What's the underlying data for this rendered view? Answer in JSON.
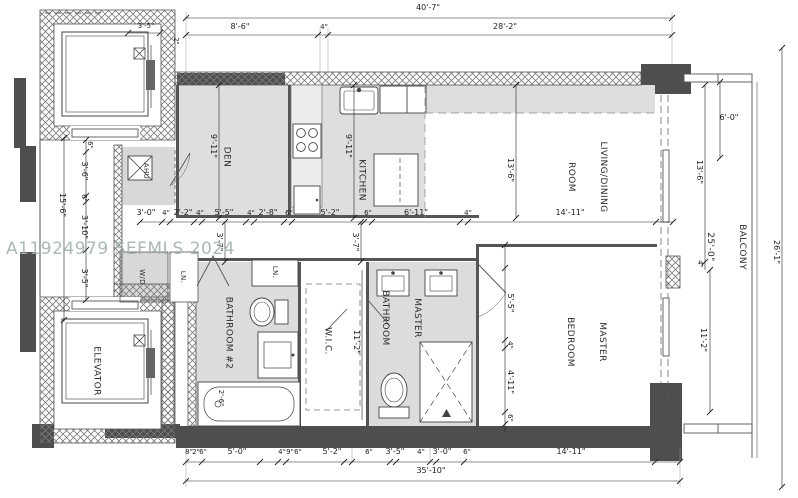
{
  "watermark": "A11924979 SEFMLS 2024",
  "rooms": {
    "den": "DEN",
    "kitchen": "KITCHEN",
    "living1": "LIVING/DINING",
    "living2": "ROOM",
    "master_bed1": "MASTER",
    "master_bed2": "BEDROOM",
    "master_bath1": "MASTER",
    "master_bath2": "BATHROOM",
    "bathroom2": "BATHROOM #2",
    "wic": "W.I.C.",
    "elevator": "ELEVATOR",
    "ahu": "AHU",
    "wd": "W/D",
    "ln1": "LN.",
    "ln2": "LN.",
    "balcony1": "BALCONY",
    "balcony2": "25'-0\""
  },
  "dims": {
    "top": {
      "overall": "40'-7\"",
      "left": "8'-6\"",
      "gap": "4\"",
      "right": "28'-2\""
    },
    "elev": {
      "width": "3'-5\"",
      "wall": "2\""
    },
    "left_chain": [
      "6\"",
      "3'-6\"",
      "6\"",
      "3'-10\"",
      "3'-5\""
    ],
    "left_overall": "15'-6\"",
    "den_depth": "9'-11\"",
    "kitchen_depth": "9'-11\"",
    "living_depth": "13'-6\"",
    "mid": [
      "3'-0\"",
      "4\"",
      "2'-2\"",
      "4\"",
      "5'-5\"",
      "4\"",
      "2'-8\"",
      "6\"",
      "5'-2\"",
      "6\"",
      "6'-11\"",
      "4\"",
      "14'-11\""
    ],
    "hall": [
      "3'-7\"",
      "3'-7\""
    ],
    "master_chain": [
      "5'-5\"",
      "4\"",
      "4'-11\"",
      "6\""
    ],
    "wic_depth": "11'-2\"",
    "tub": "2'-6\"",
    "balcony": {
      "d6": "6'-0\"",
      "d13": "13'-6\"",
      "d4": "4\"",
      "d11": "11'-2\"",
      "overall": "26'-1\""
    },
    "bottom": [
      "8\"",
      "2\"",
      "6\"",
      "5'-0\"",
      "4\"",
      "9\"",
      "6\"",
      "5'-2\"",
      "6\"",
      "3'-5\"",
      "4\"",
      "3'-0\"",
      "6\"",
      "14'-11\""
    ],
    "bottom_overall": "35'-10\""
  }
}
